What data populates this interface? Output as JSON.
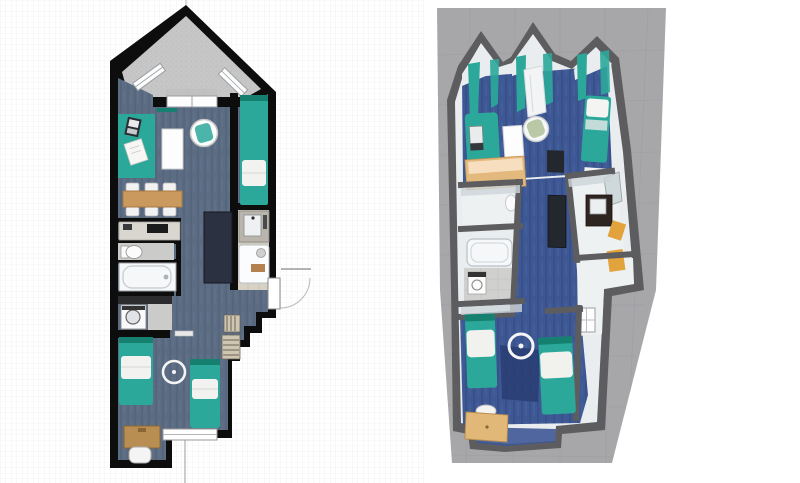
{
  "app": {
    "title": "Home design workspace — 2D floor plan with 3D aerial view",
    "visible_text": "none"
  },
  "colors": {
    "wall2d": "#0d0d0d",
    "carpet2d": "#5c6c83",
    "carpet2dDark": "#47586f",
    "carpet3d": "#3e5895",
    "carpet3dDark": "#2a3f74",
    "teal": "#2ba89a",
    "tealDark": "#15806f",
    "balcony": "#c6c6c6",
    "wood": "#c9995e",
    "woodDark": "#b98e52",
    "counter": "#d9d6cf",
    "tile": "#cbcbc9",
    "beigeTile": "#d8d1c6",
    "navy": "#2b3140",
    "tub": "#f5f7f8",
    "ground3d": "#a7a7aa",
    "wall3d": "#5d5d5f",
    "wallFace3d": "#e9edef",
    "wallFaceShade": "#cdd5d9",
    "yellow": "#e2a23c",
    "sage": "#b9c9a8",
    "frame": "#9aa0a5",
    "dimension": "#9b9b9b",
    "grid": "#e7eaec",
    "background": "#ffffff"
  },
  "panels": {
    "plan2d": {
      "label": "2D floor plan",
      "rooms": [
        "balcony",
        "living-room",
        "kitchen-dining",
        "wc",
        "bathroom-bathtub",
        "laundry",
        "shower-room",
        "hallway",
        "bedroom",
        "desk-alcove"
      ],
      "furniture": [
        "teal-desk-mat",
        "laptop",
        "papers",
        "white-table",
        "swivel-armchair",
        "single-bed-right",
        "dining-table",
        "six-chairs",
        "kitchen-counter",
        "cooktop",
        "toilet",
        "bathtub",
        "washing-machine",
        "wardrobe",
        "vanity-sink",
        "shower",
        "radiator-upper",
        "radiator-lower",
        "bed-left",
        "bed-right",
        "ceiling-light",
        "writing-desk",
        "desk-chair"
      ],
      "openings": [
        "balcony-window-left",
        "balcony-window-right",
        "patio-door",
        "entrance-door",
        "bedroom-window"
      ]
    },
    "view3d": {
      "label": "3D aerial view",
      "elements": [
        "ground-plane",
        "gabled-walls",
        "teal-curtains",
        "window-bay-column",
        "teal-daybed",
        "laptop",
        "white-desk",
        "armchair",
        "bed-top-right",
        "teal-stool",
        "kitchen-counter",
        "toilet",
        "bathtub",
        "washing-machine",
        "tv-cabinet",
        "wardrobe",
        "vanity-with-mirror",
        "yellow-towels",
        "bed-left",
        "bed-right",
        "dark-rug",
        "ceiling-light",
        "writing-desk",
        "entrance-window"
      ]
    }
  }
}
